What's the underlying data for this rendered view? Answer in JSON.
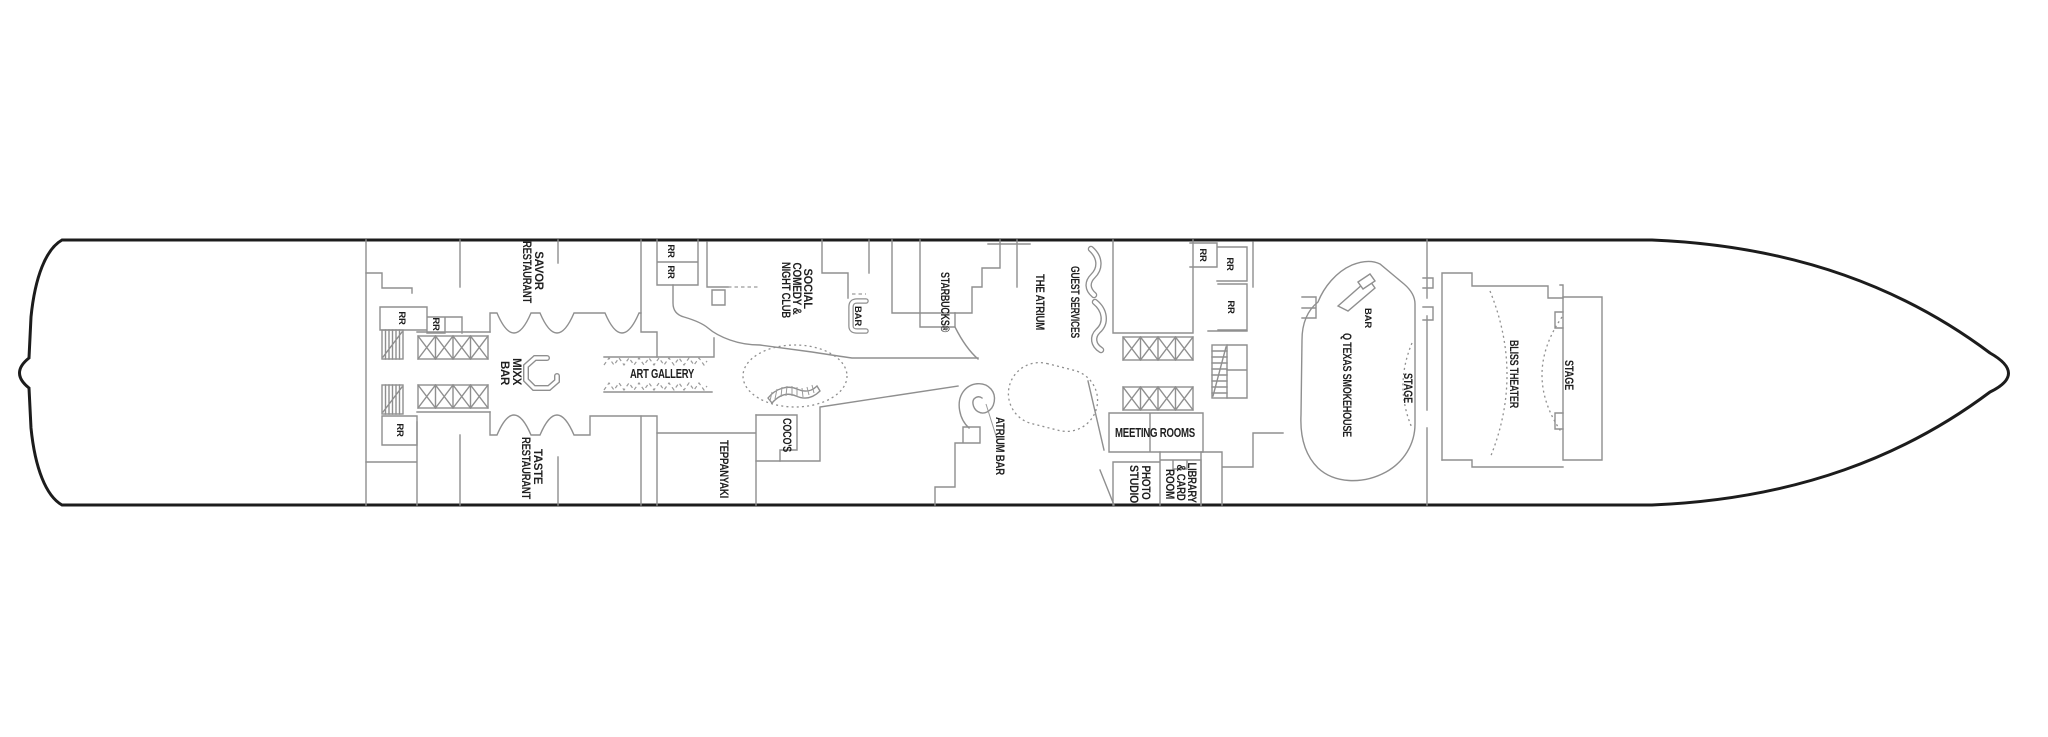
{
  "page": {
    "background": "#ffffff"
  },
  "deck_plan": {
    "type": "cruise-ship-deck-plan",
    "orientation": "bow-right-stern-left",
    "colors": {
      "hull_outline": "#1c1c1c",
      "interior_walls": "#8f8f8f",
      "label_text": "#1f1f1f",
      "background": "#ffffff"
    },
    "labels": {
      "rr": "RR",
      "savor": {
        "lines": [
          "SAVOR",
          "RESTAURANT"
        ]
      },
      "taste": {
        "lines": [
          "TASTE",
          "RESTAURANT"
        ]
      },
      "mixx": {
        "lines": [
          "MIXX",
          "BAR"
        ]
      },
      "art_gallery": "ART GALLERY",
      "social": {
        "lines": [
          "SOCIAL",
          "COMEDY &",
          "NIGHT CLUB"
        ]
      },
      "club_bar": "BAR",
      "starbucks": "STARBUCKS®",
      "cocos": "COCO'S",
      "teppanyaki": "TEPPANYAKI",
      "the_atrium": "THE ATRIUM",
      "guest_services": "GUEST SERVICES",
      "atrium_bar": "ATRIUM BAR",
      "meeting_rooms": "MEETING ROOMS",
      "photo_studio": {
        "lines": [
          "PHOTO",
          "STUDIO"
        ]
      },
      "library": {
        "lines": [
          "LIBRARY",
          "& CARD",
          "ROOM"
        ]
      },
      "q_texas_bar": "BAR",
      "q_texas": "Q TEXAS SMOKEHOUSE",
      "q_texas_stage": "STAGE",
      "bliss_theater": "BLISS THEATER",
      "bliss_stage": "STAGE"
    }
  }
}
